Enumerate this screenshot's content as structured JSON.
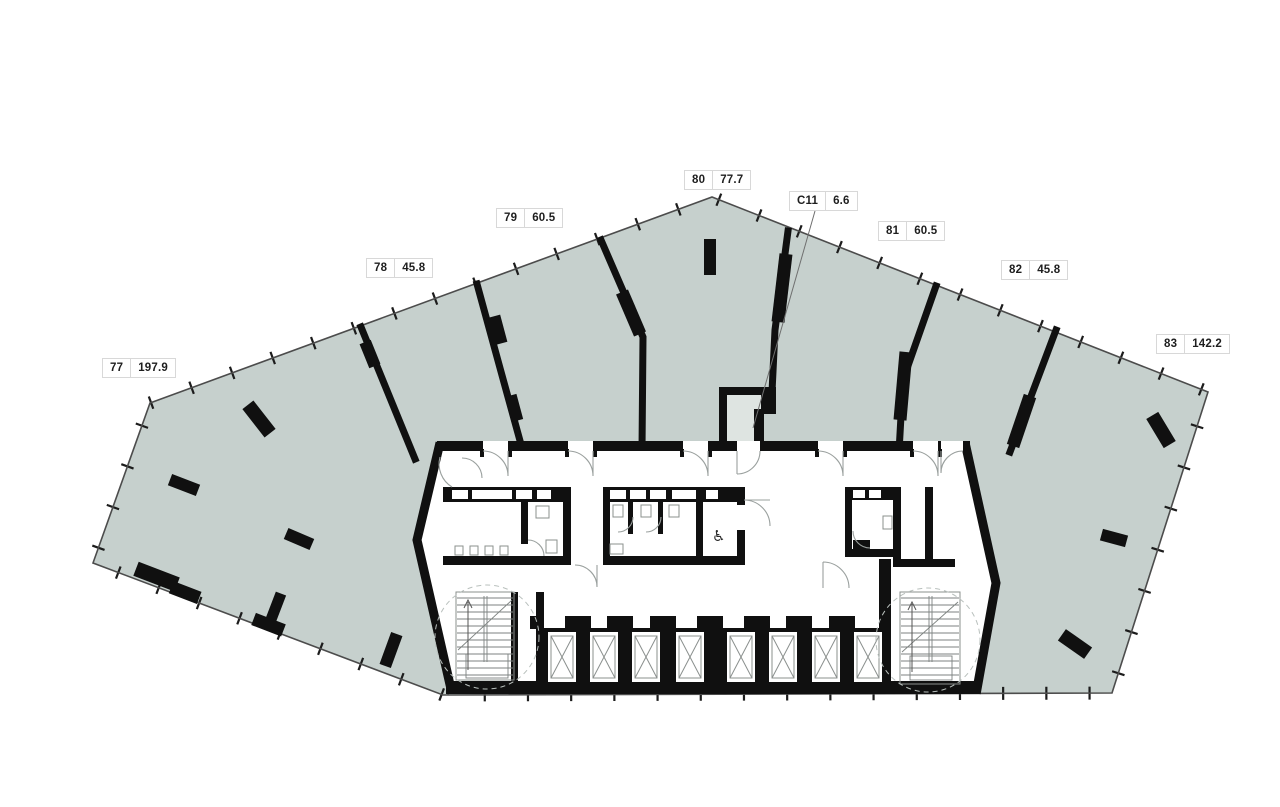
{
  "plan_title": "Floor plan",
  "units": [
    {
      "id": "77",
      "area": "197.9"
    },
    {
      "id": "78",
      "area": "45.8"
    },
    {
      "id": "79",
      "area": "60.5"
    },
    {
      "id": "80",
      "area": "77.7"
    },
    {
      "id": "81",
      "area": "60.5"
    },
    {
      "id": "82",
      "area": "45.8"
    },
    {
      "id": "83",
      "area": "142.2"
    },
    {
      "id": "C11",
      "area": "6.6"
    }
  ],
  "icons": {
    "wheelchair": "♿"
  },
  "colors": {
    "floor_fill": "#c6d0cd",
    "small_room_fill": "#dee4e1",
    "wall": "#101010",
    "background": "#ffffff"
  }
}
